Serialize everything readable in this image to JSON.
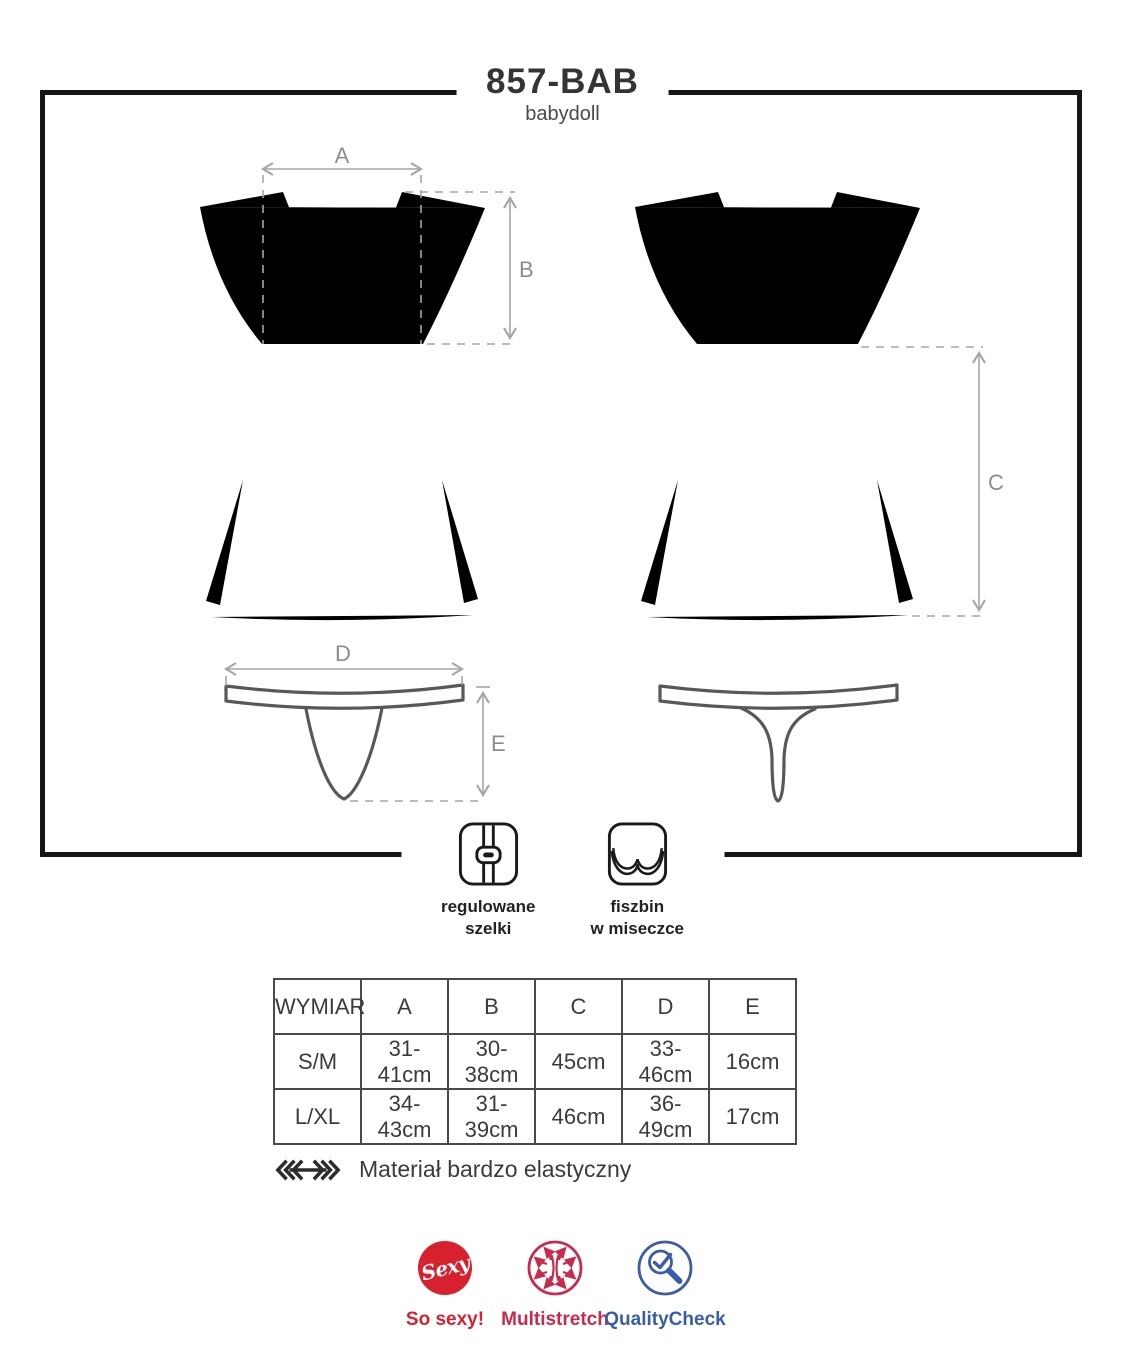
{
  "header": {
    "model": "857-BAB",
    "subtitle": "babydoll"
  },
  "diagram": {
    "dimension_labels": {
      "a": "A",
      "b": "B",
      "c": "C",
      "d": "D",
      "e": "E"
    },
    "pieces": [
      "babydoll-front",
      "babydoll-back",
      "thong-front",
      "thong-back"
    ],
    "line_color": "#57585a",
    "dimension_color": "#a6a6a6"
  },
  "features": [
    {
      "icon": "adjustable-straps-icon",
      "line1": "regulowane",
      "line2": "szelki"
    },
    {
      "icon": "underwire-cup-icon",
      "line1": "fiszbin",
      "line2": "w miseczce"
    }
  ],
  "size_table": {
    "headers": [
      "WYMIAR",
      "A",
      "B",
      "C",
      "D",
      "E"
    ],
    "rows": [
      {
        "label": "S/M",
        "values": [
          "31-41cm",
          "30-38cm",
          "45cm",
          "33-46cm",
          "16cm"
        ]
      },
      {
        "label": "L/XL",
        "values": [
          "34-43cm",
          "31-39cm",
          "46cm",
          "36-49cm",
          "17cm"
        ]
      }
    ]
  },
  "material_note": {
    "icon": "stretch-arrow-icon",
    "text": "Materiał bardzo elastyczny"
  },
  "badges": [
    {
      "icon": "sexy-dot-icon",
      "icon_text": "Sexy",
      "label": "So sexy!",
      "color": "#d7212e"
    },
    {
      "icon": "multistretch-arrows-icon",
      "label": "Multistretch",
      "color": "#c72b4d"
    },
    {
      "icon": "quality-check-magnifier-icon",
      "label": "QualityCheck",
      "color": "#3a5ca9"
    }
  ],
  "frame_color": "#161616"
}
